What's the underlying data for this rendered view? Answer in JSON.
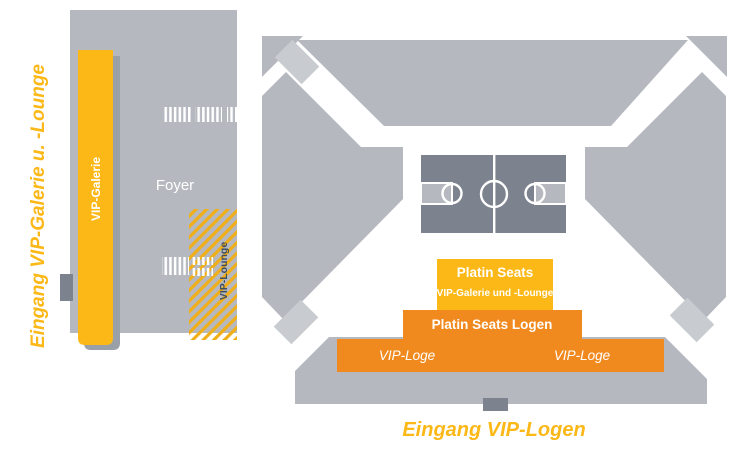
{
  "map": {
    "left_entrance_label": "Eingang VIP-Galerie u. -Lounge",
    "bottom_entrance_label": "Eingang VIP-Logen",
    "foyer_label": "Foyer",
    "vip_galerie_label": "VIP-Galerie",
    "vip_lounge_label": "VIP-Lounge",
    "platin_seats_title": "Platin Seats",
    "platin_seats_subtitle": "VIP-Galerie und -Lounge",
    "platin_logen_label": "Platin Seats Logen",
    "vip_loge_left_label": "VIP-Loge",
    "vip_loge_right_label": "VIP-Loge",
    "colors": {
      "yellow": "#fbb817",
      "orange": "#f18a1e",
      "hatch_yellow": "#f0ae19",
      "stand_gray": "#b5b9bf",
      "court_gray": "#7d838e",
      "door_light_gray": "#c8cbd0",
      "lounge_text": "#3d4c5e"
    }
  }
}
